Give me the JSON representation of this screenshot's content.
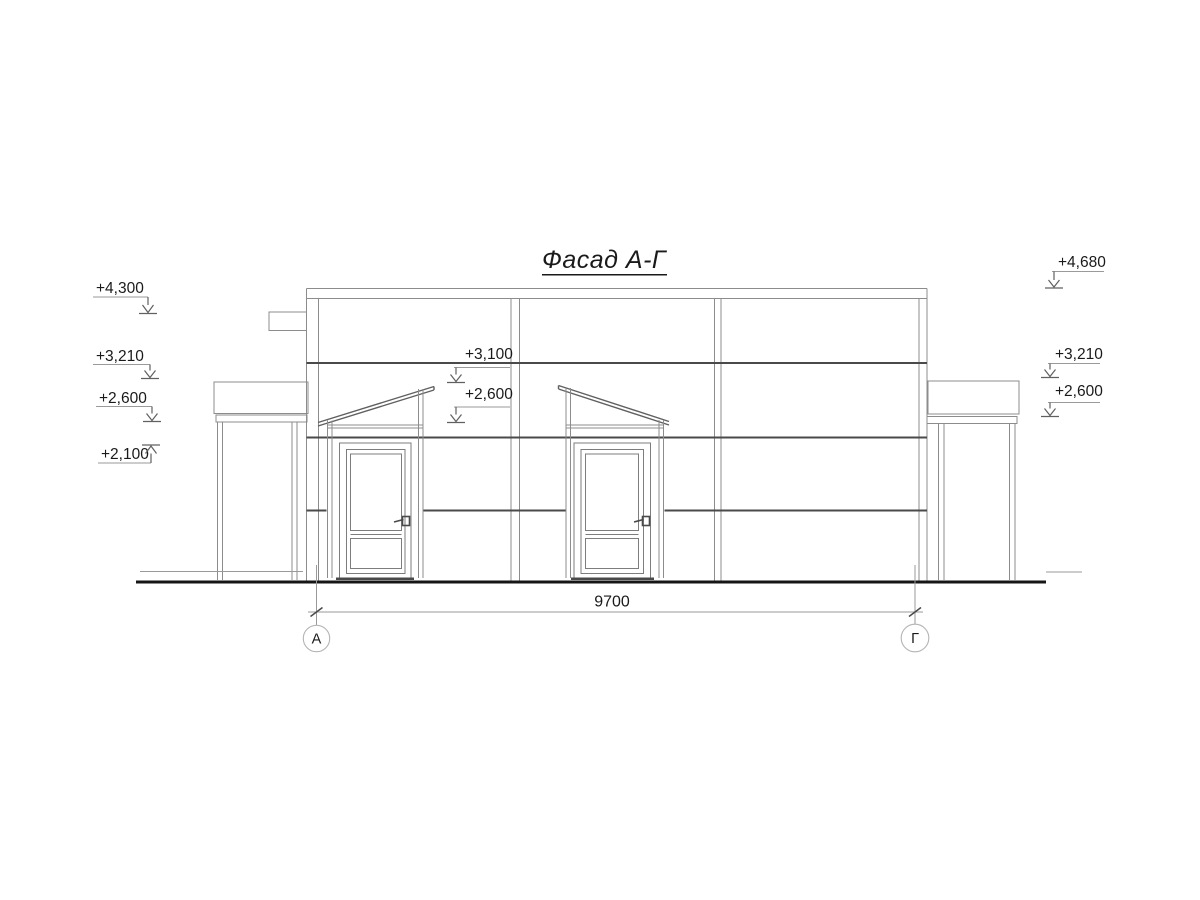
{
  "title": {
    "text": "Фасад А-Г"
  },
  "drawing_type": "architectural-elevation",
  "marks": {
    "left": [
      {
        "label": "+4,300"
      },
      {
        "label": "+3,210"
      },
      {
        "label": "+2,600"
      },
      {
        "label": "+2,100"
      }
    ],
    "middle": [
      {
        "label": "+3,100"
      },
      {
        "label": "+2,600"
      }
    ],
    "right": [
      {
        "label": "+4,680"
      },
      {
        "label": "+3,210"
      },
      {
        "label": "+2,600"
      }
    ]
  },
  "dimension": {
    "length": "9700"
  },
  "axes": {
    "left": "А",
    "right": "Г"
  },
  "colors": {
    "line_thin": "#8c8c8c",
    "line_med": "#606060",
    "line_thick": "#4a4a4a",
    "line_door": "#7d7d7d",
    "line_dim": "#9a9a9a",
    "line_circle": "#b4b4b4",
    "ground": "#161616",
    "text": "#1a1a1a"
  }
}
